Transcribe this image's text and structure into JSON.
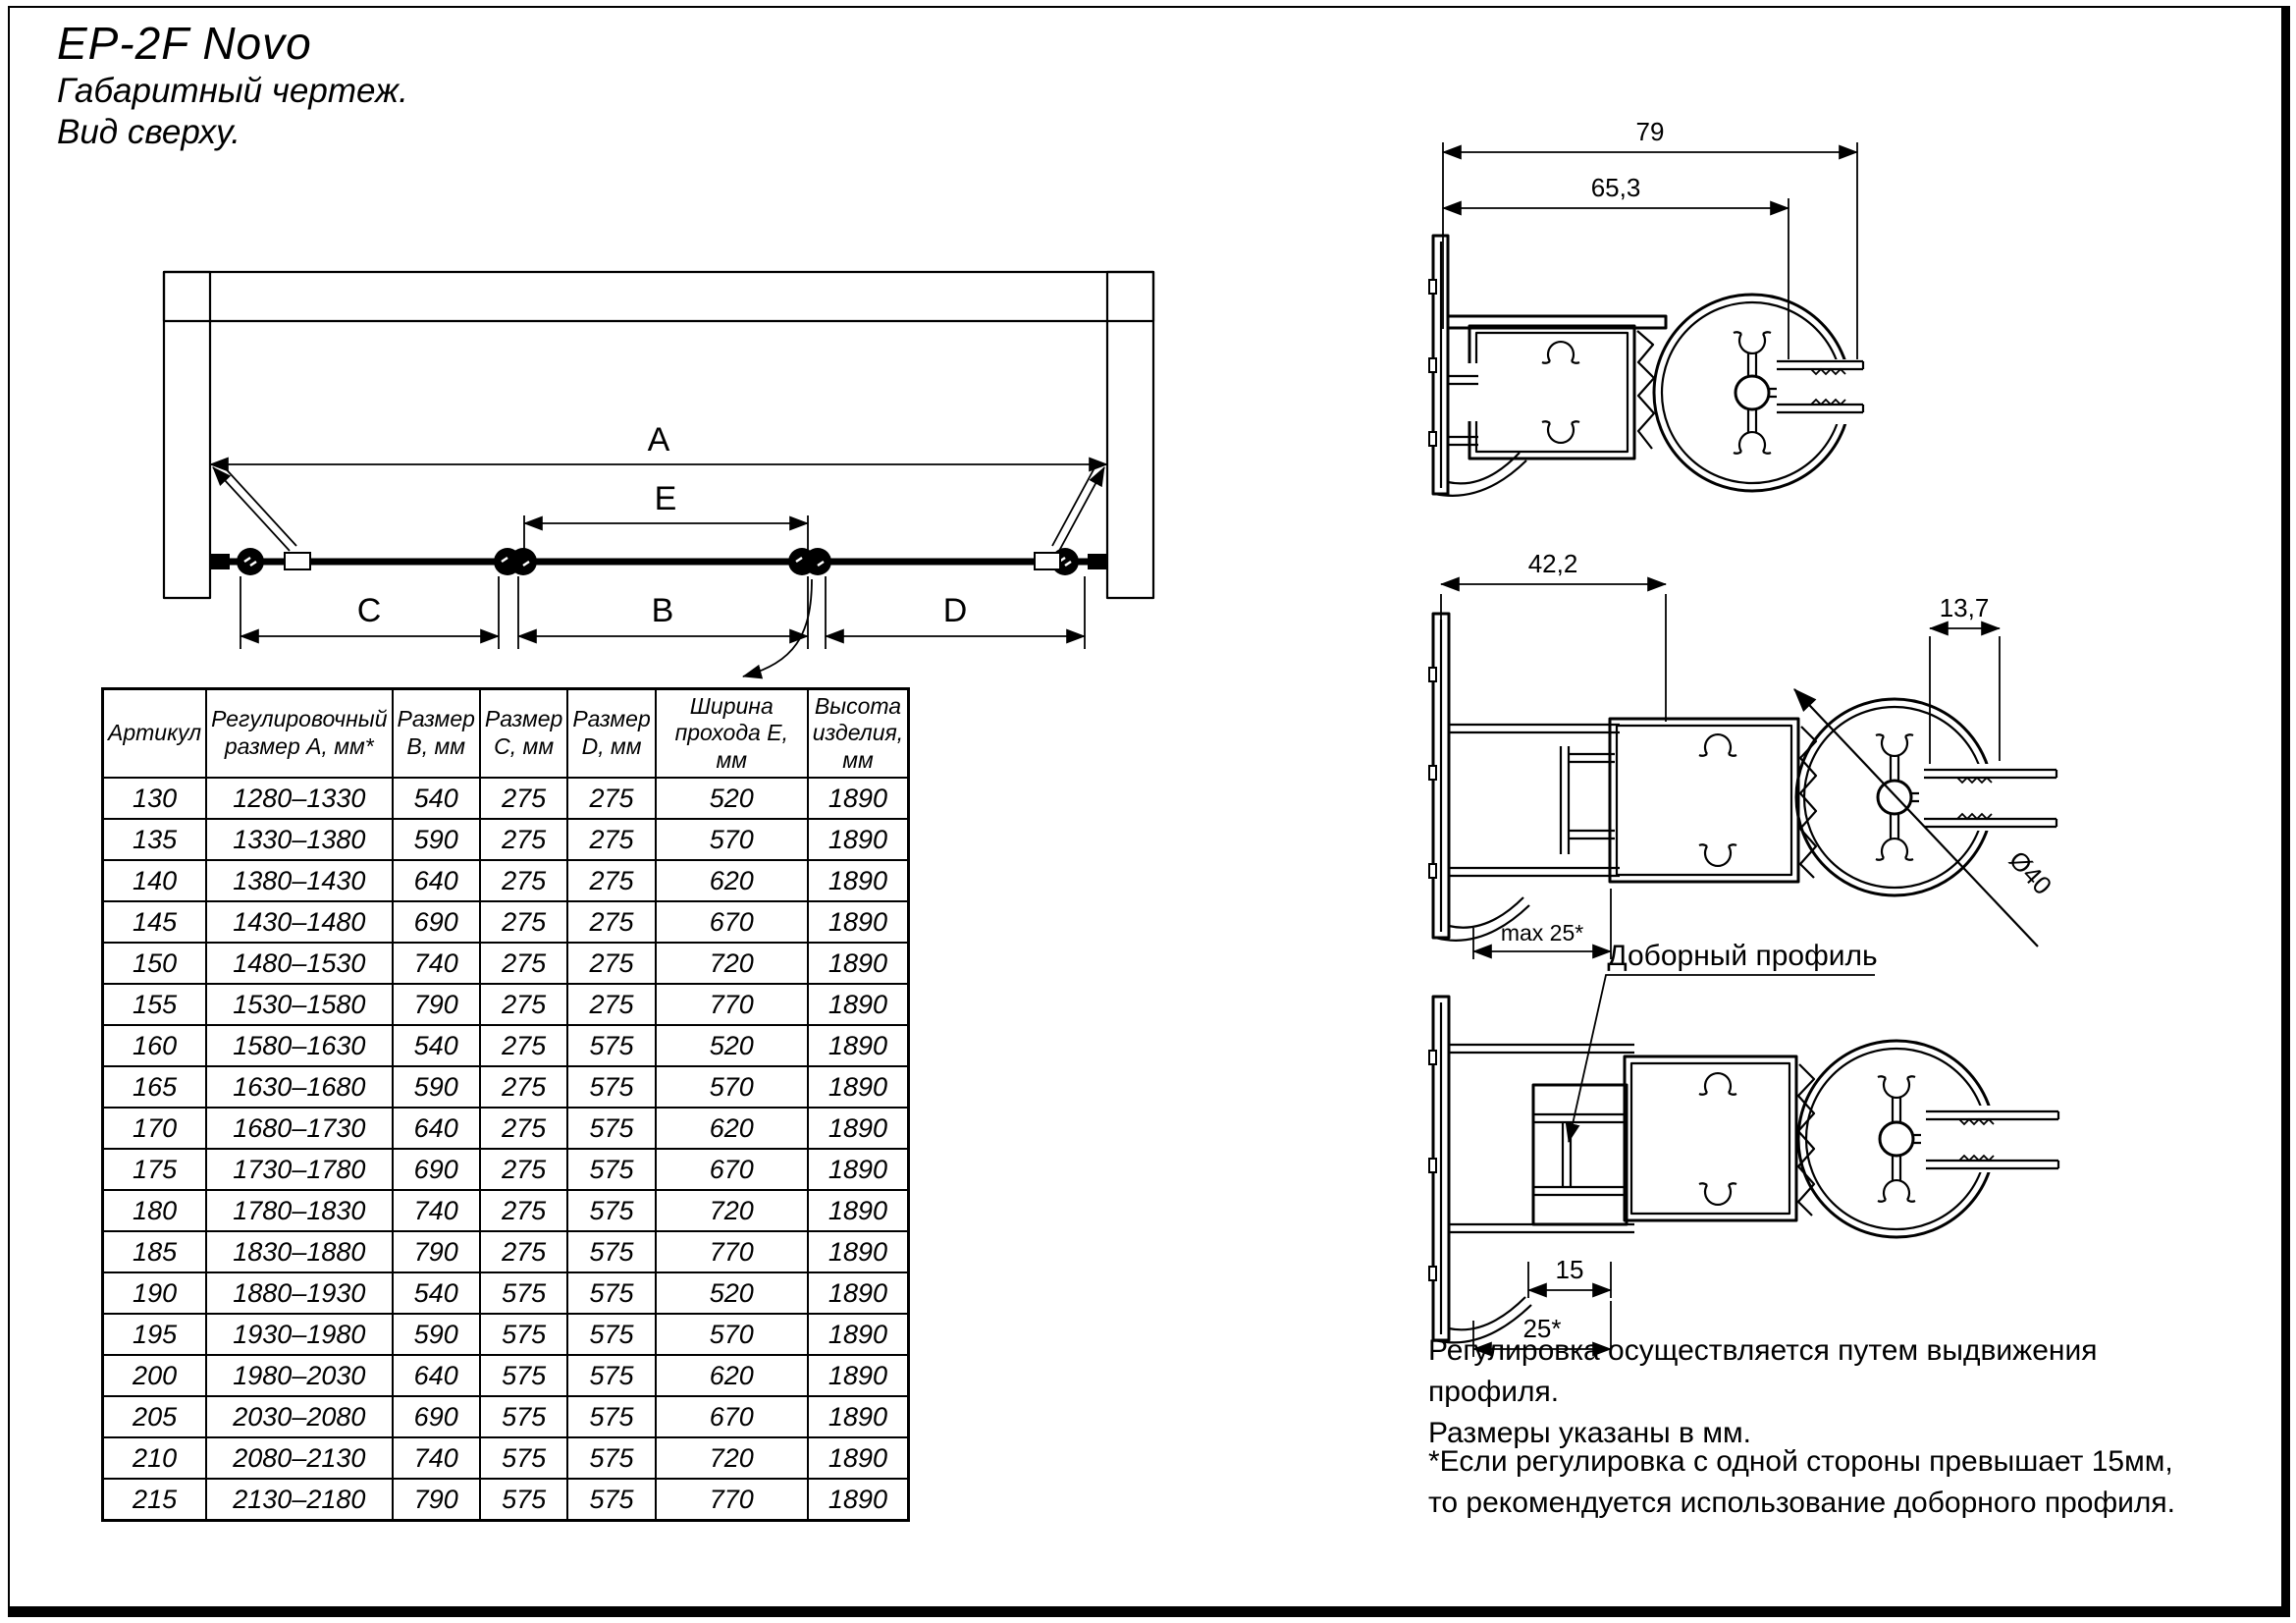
{
  "header": {
    "title": "EP-2F Novo",
    "subtitle1": "Габаритный чертеж.",
    "subtitle2": "Вид сверху."
  },
  "top_view": {
    "dim_a": "A",
    "dim_b": "B",
    "dim_c": "C",
    "dim_d": "D",
    "dim_e": "E"
  },
  "table": {
    "headers": [
      "Артикул",
      "Регулировочный размер А, мм*",
      "Размер В, мм",
      "Размер С, мм",
      "Размер D, мм",
      "Ширина прохода Е, мм",
      "Высота изделия, мм"
    ],
    "rows": [
      [
        "130",
        "1280–1330",
        "540",
        "275",
        "275",
        "520",
        "1890"
      ],
      [
        "135",
        "1330–1380",
        "590",
        "275",
        "275",
        "570",
        "1890"
      ],
      [
        "140",
        "1380–1430",
        "640",
        "275",
        "275",
        "620",
        "1890"
      ],
      [
        "145",
        "1430–1480",
        "690",
        "275",
        "275",
        "670",
        "1890"
      ],
      [
        "150",
        "1480–1530",
        "740",
        "275",
        "275",
        "720",
        "1890"
      ],
      [
        "155",
        "1530–1580",
        "790",
        "275",
        "275",
        "770",
        "1890"
      ],
      [
        "160",
        "1580–1630",
        "540",
        "275",
        "575",
        "520",
        "1890"
      ],
      [
        "165",
        "1630–1680",
        "590",
        "275",
        "575",
        "570",
        "1890"
      ],
      [
        "170",
        "1680–1730",
        "640",
        "275",
        "575",
        "620",
        "1890"
      ],
      [
        "175",
        "1730–1780",
        "690",
        "275",
        "575",
        "670",
        "1890"
      ],
      [
        "180",
        "1780–1830",
        "740",
        "275",
        "575",
        "720",
        "1890"
      ],
      [
        "185",
        "1830–1880",
        "790",
        "275",
        "575",
        "770",
        "1890"
      ],
      [
        "190",
        "1880–1930",
        "540",
        "575",
        "575",
        "520",
        "1890"
      ],
      [
        "195",
        "1930–1980",
        "590",
        "575",
        "575",
        "570",
        "1890"
      ],
      [
        "200",
        "1980–2030",
        "640",
        "575",
        "575",
        "620",
        "1890"
      ],
      [
        "205",
        "2030–2080",
        "690",
        "575",
        "575",
        "670",
        "1890"
      ],
      [
        "210",
        "2080–2130",
        "740",
        "575",
        "575",
        "720",
        "1890"
      ],
      [
        "215",
        "2130–2180",
        "790",
        "575",
        "575",
        "770",
        "1890"
      ]
    ]
  },
  "profiles": {
    "top_section": {
      "dim_width": "79",
      "dim_inner": "65,3"
    },
    "mid_section": {
      "dim_width": "42,2",
      "dim_slot": "13,7",
      "dim_dia": "Ø40",
      "dim_max": "max 25*"
    },
    "bottom_section": {
      "label": "Доборный профиль",
      "dim_insert": "15",
      "dim_adjust": "25*"
    }
  },
  "notes": {
    "adjust_line1": "Регулировка осуществляется путем выдвижения профиля.",
    "adjust_line2": "Размеры указаны в мм.",
    "asterisk_line1": "*Если регулировка с одной стороны превышает 15мм,",
    "asterisk_line2": "то рекомендуется использование доборного профиля."
  },
  "colors": {
    "ink": "#000000",
    "paper": "#ffffff"
  }
}
